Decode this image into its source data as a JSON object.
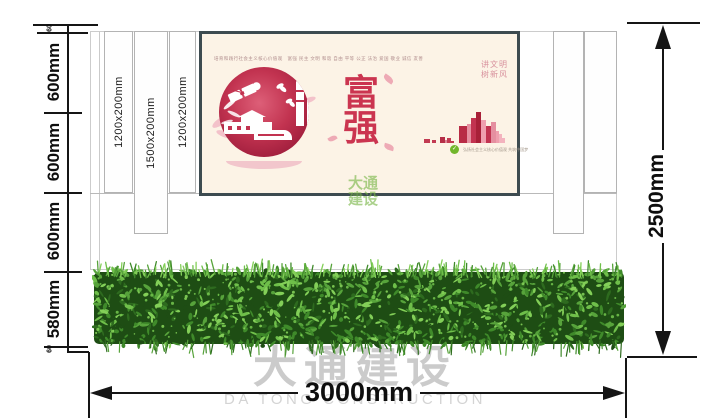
{
  "drawing": {
    "left_dimensions": [
      "60",
      "600mm",
      "600mm",
      "600mm",
      "580mm",
      "60"
    ],
    "right_dimension": "2500mm",
    "bottom_dimension": "3000mm",
    "slat_labels": [
      "1200x200mm",
      "1500x200mm",
      "1200x200mm"
    ]
  },
  "poster": {
    "header_text": "培育和践行社会主义核心价值观　富强 民主 文明 和谐 自由 平等 公正 法治 爱国 敬业 诚信 友善",
    "char_top": "富",
    "char_bottom": "强",
    "slogan_line1": "讲文明",
    "slogan_line2": "树新风",
    "footer_note": "弘扬社会主义核心价值观 共筑中国梦",
    "eco_dot_glyph": "✓",
    "colors": {
      "background": "#fcf3e6",
      "frame": "#3d4b50",
      "main_red": "#cb3550",
      "slogan_pink": "#d8919d",
      "emblem_red": "#b02344",
      "emblem_red_light": "#d9536e",
      "leaf_pink": "#eeaab5",
      "crescent_pink": "#f2c6cc",
      "dot_green": "#72b62c"
    },
    "skyline_bars": [
      [
        6,
        4,
        "#c23a52"
      ],
      [
        2,
        0,
        null
      ],
      [
        4,
        3,
        "#c23a52"
      ],
      [
        4,
        0,
        null
      ],
      [
        5,
        6,
        "#b52e47"
      ],
      [
        2,
        3,
        "#db8394"
      ],
      [
        4,
        5,
        "#c23a52"
      ],
      [
        3,
        2,
        "#c23a52"
      ],
      [
        5,
        0,
        null
      ],
      [
        8,
        17,
        "#b82b45"
      ],
      [
        4,
        19,
        "#e58fa0"
      ],
      [
        5,
        25,
        "#c23350"
      ],
      [
        5,
        31,
        "#a82038"
      ],
      [
        5,
        23,
        "#ef9fae"
      ],
      [
        5,
        17,
        "#c23350"
      ],
      [
        5,
        21,
        "#e58fa0"
      ],
      [
        3,
        12,
        "#ef9fae"
      ],
      [
        3,
        9,
        "#f3b3be"
      ],
      [
        3,
        5,
        "#f3b3be"
      ]
    ]
  },
  "hedge": {
    "colors": [
      "#1e4d14",
      "#2e6b1f",
      "#3f8a2a",
      "#57a33b",
      "#6fbf4a",
      "#83cf58"
    ]
  },
  "watermarks": {
    "center_line1": "大通",
    "center_line2": "建设",
    "bottom_cn": "大通建设",
    "bottom_en": "DA TONG CONSTRUCTION"
  }
}
